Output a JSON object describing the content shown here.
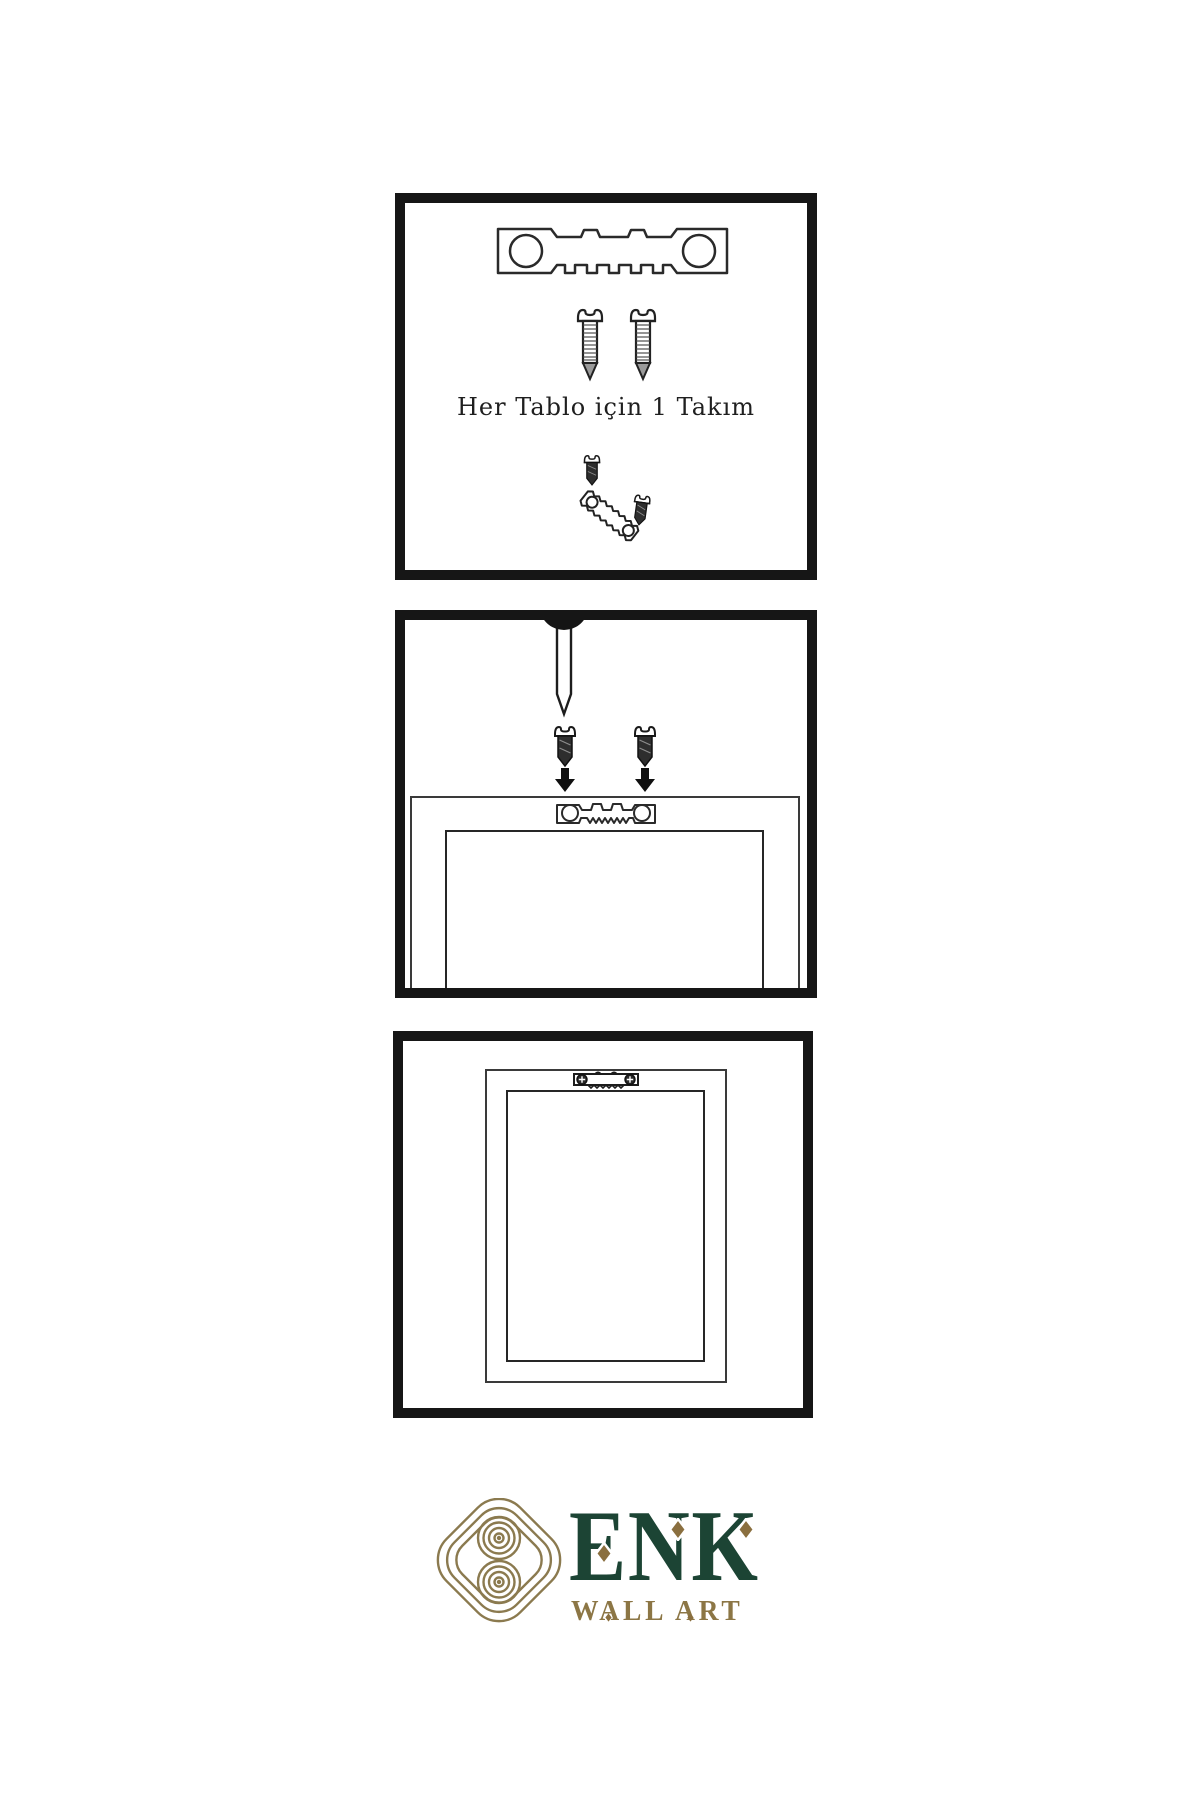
{
  "page": {
    "background": "#ffffff",
    "type": "wall-art-hanging-instruction-sheet"
  },
  "panels": {
    "kit": {
      "caption": "Her Tablo için 1 Takım",
      "icons": [
        "sawtooth-hanger-icon",
        "screw-icon",
        "screw-icon",
        "screw-icon",
        "tilted-sawtooth-hanger-icon"
      ]
    },
    "install": {
      "icons": [
        "nail-icon",
        "screw-icon",
        "screw-icon",
        "arrow-down-icon",
        "arrow-down-icon",
        "frame-back-icon",
        "sawtooth-hanger-icon"
      ]
    },
    "hang": {
      "icons": [
        "frame-back-icon",
        "mounted-sawtooth-hanger-icon"
      ]
    }
  },
  "brand": {
    "name": "ENK",
    "tagline": "WALL ART",
    "logo": "knot-logo-icon"
  },
  "colors": {
    "line": "#2a2a2a",
    "panel_border": "#161616",
    "screw_dark": "#2e2e2e",
    "brand_green": "#1c4434",
    "brand_gold": "#8c7645",
    "knot_gold": "#8b7a4f",
    "diamond_gold": "#8a6f3f"
  }
}
